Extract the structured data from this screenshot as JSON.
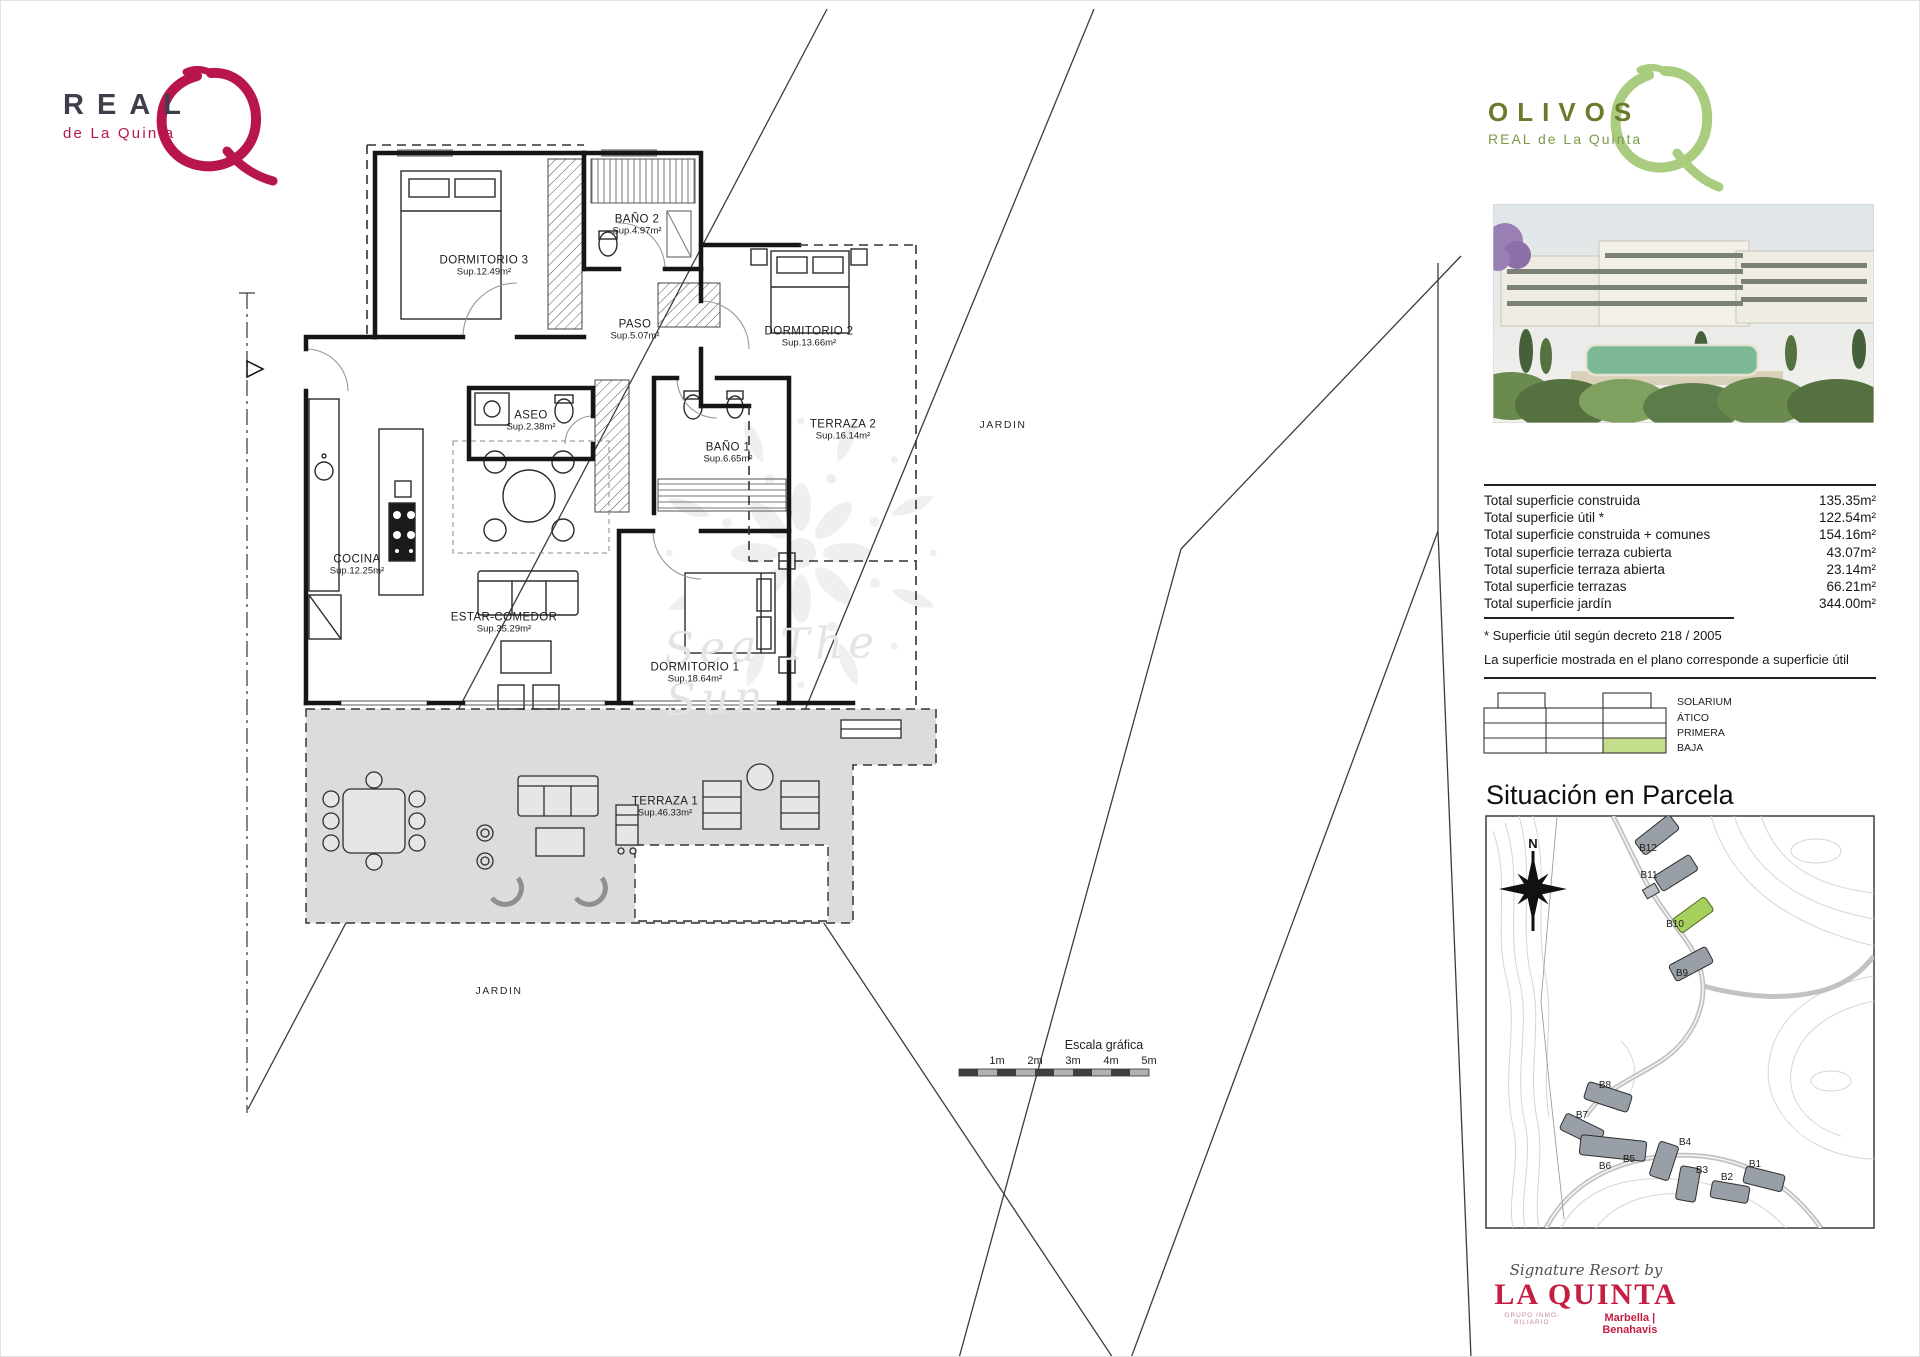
{
  "brand_left": {
    "name": "REAL",
    "tagline": "de La Quinta"
  },
  "brand_right": {
    "name": "OLIVOS",
    "tagline": "REAL de La Quinta"
  },
  "summary": {
    "rows": [
      {
        "label": "Total superficie construida",
        "value": "135.35m²"
      },
      {
        "label": "Total superficie útil *",
        "value": "122.54m²"
      },
      {
        "label": "Total superficie construida + comunes",
        "value": "154.16m²"
      },
      {
        "label": "Total superficie terraza cubierta",
        "value": "43.07m²"
      },
      {
        "label": "Total superficie terraza abierta",
        "value": "23.14m²"
      },
      {
        "label": "Total superficie terrazas",
        "value": "66.21m²"
      },
      {
        "label": "Total superficie jardín",
        "value": "344.00m²"
      }
    ],
    "footnotes": [
      "* Superficie útil según decreto 218 / 2005",
      "La superficie mostrada en el plano corresponde a superficie útil"
    ]
  },
  "levels": {
    "items": [
      "SOLARIUM",
      "ÁTICO",
      "PRIMERA",
      "BAJA"
    ],
    "highlighted": "BAJA",
    "highlight_color": "#c3dd8b"
  },
  "parcela": {
    "heading": "Situación en Parcela",
    "compass": "N",
    "buildings": [
      "B12",
      "B11",
      "B10",
      "B9",
      "B8",
      "B7",
      "B6",
      "B5",
      "B4",
      "B3",
      "B2",
      "B1"
    ],
    "highlighted_building": "B10",
    "highlight_color": "#a6cf5e"
  },
  "plan": {
    "rooms": [
      {
        "name": "DORMITORIO 3",
        "area": "Sup.12.49m²"
      },
      {
        "name": "BAÑO 2",
        "area": "Sup.4.97m²"
      },
      {
        "name": "PASO",
        "area": "Sup.5.07m²"
      },
      {
        "name": "DORMITORIO 2",
        "area": "Sup.13.66m²"
      },
      {
        "name": "ASEO",
        "area": "Sup.2.38m²"
      },
      {
        "name": "BAÑO 1",
        "area": "Sup.6.65m²"
      },
      {
        "name": "TERRAZA 2",
        "area": "Sup.16.14m²"
      },
      {
        "name": "COCINA",
        "area": "Sup.12.25m²"
      },
      {
        "name": "ESTAR-COMEDOR",
        "area": "Sup.35.29m²"
      },
      {
        "name": "DORMITORIO 1",
        "area": "Sup.18.64m²"
      },
      {
        "name": "TERRAZA 1",
        "area": "Sup.46.33m²"
      }
    ],
    "jardin_labels": [
      "JARDIN",
      "JARDIN"
    ],
    "watermark": "Sea The Sun"
  },
  "scale_bar": {
    "title": "Escala gráfica",
    "ticks": [
      "1m",
      "2m",
      "3m",
      "4m",
      "5m"
    ]
  },
  "footer": {
    "script": "Signature Resort by",
    "brand": "LA QUINTA",
    "left_sub": "GRUPO INMO­BILIARIO",
    "right_sub": "Marbella | Benahavis"
  },
  "colors": {
    "crimson_brand": "#b8154f",
    "olive_brand": "#6c7a2c",
    "light_green_q": "#a9cc7e",
    "level_highlight": "#c3dd8b",
    "building_highlight": "#a6cf5e",
    "laquinta_red": "#c41e42",
    "terrace_gray": "#dcdcdc"
  }
}
